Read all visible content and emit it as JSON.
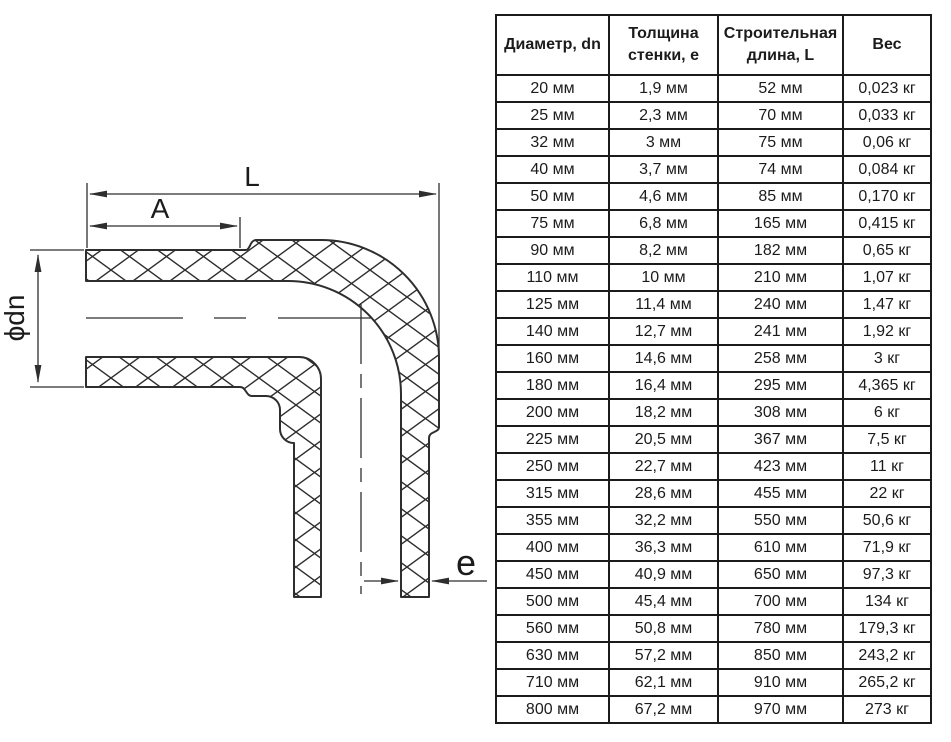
{
  "colors": {
    "line": "#2e2e2e",
    "table_border": "#1b1b1b",
    "text": "#1b1b1b",
    "background": "#ffffff"
  },
  "diagram": {
    "description": "90-degree elbow pipe fitting cross-section",
    "labels": {
      "overall_length": "L",
      "socket_depth": "A",
      "diameter": "ϕdn",
      "wall_thickness": "e"
    }
  },
  "table": {
    "headers": [
      "Диаметр, dn",
      "Толщина стенки, е",
      "Строительная длина, L",
      "Вес"
    ],
    "rows": [
      [
        "20 мм",
        "1,9 мм",
        "52 мм",
        "0,023 кг"
      ],
      [
        "25 мм",
        "2,3 мм",
        "70 мм",
        "0,033 кг"
      ],
      [
        "32 мм",
        "3 мм",
        "75 мм",
        "0,06 кг"
      ],
      [
        "40 мм",
        "3,7 мм",
        "74 мм",
        "0,084 кг"
      ],
      [
        "50 мм",
        "4,6 мм",
        "85 мм",
        "0,170 кг"
      ],
      [
        "75 мм",
        "6,8 мм",
        "165 мм",
        "0,415 кг"
      ],
      [
        "90 мм",
        "8,2 мм",
        "182 мм",
        "0,65 кг"
      ],
      [
        "110 мм",
        "10 мм",
        "210 мм",
        "1,07 кг"
      ],
      [
        "125 мм",
        "11,4 мм",
        "240 мм",
        "1,47 кг"
      ],
      [
        "140 мм",
        "12,7 мм",
        "241 мм",
        "1,92 кг"
      ],
      [
        "160 мм",
        "14,6 мм",
        "258 мм",
        "3 кг"
      ],
      [
        "180 мм",
        "16,4 мм",
        "295 мм",
        "4,365 кг"
      ],
      [
        "200 мм",
        "18,2 мм",
        "308 мм",
        "6 кг"
      ],
      [
        "225 мм",
        "20,5 мм",
        "367 мм",
        "7,5 кг"
      ],
      [
        "250 мм",
        "22,7 мм",
        "423 мм",
        "11 кг"
      ],
      [
        "315 мм",
        "28,6 мм",
        "455 мм",
        "22 кг"
      ],
      [
        "355 мм",
        "32,2 мм",
        "550 мм",
        "50,6 кг"
      ],
      [
        "400 мм",
        "36,3 мм",
        "610 мм",
        "71,9 кг"
      ],
      [
        "450 мм",
        "40,9 мм",
        "650 мм",
        "97,3 кг"
      ],
      [
        "500 мм",
        "45,4 мм",
        "700 мм",
        "134 кг"
      ],
      [
        "560 мм",
        "50,8 мм",
        "780 мм",
        "179,3 кг"
      ],
      [
        "630 мм",
        "57,2 мм",
        "850 мм",
        "243,2 кг"
      ],
      [
        "710 мм",
        "62,1 мм",
        "910 мм",
        "265,2 кг"
      ],
      [
        "800 мм",
        "67,2 мм",
        "970 мм",
        "273 кг"
      ]
    ]
  }
}
